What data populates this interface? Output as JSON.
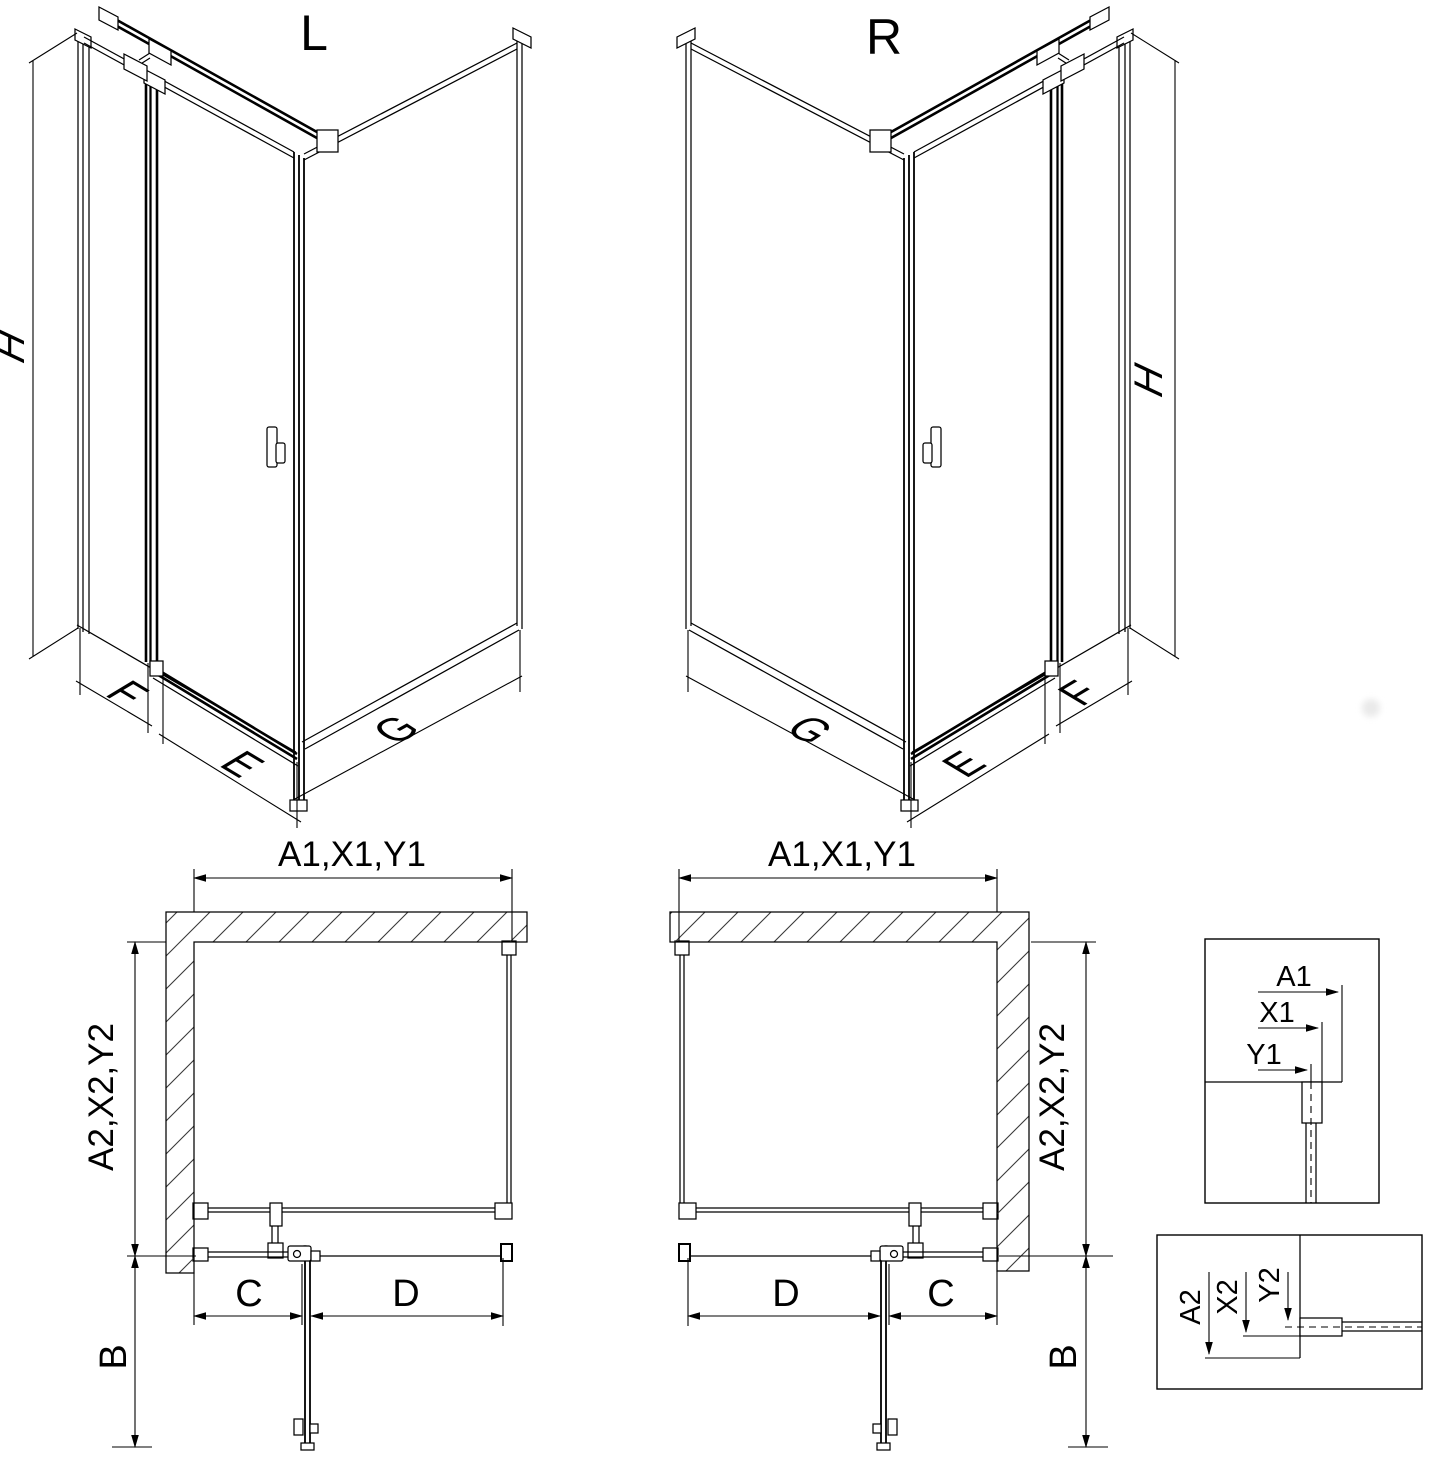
{
  "drawing": {
    "views": {
      "iso_left": {
        "label": "L",
        "dim_height": "H",
        "dim_side": "F",
        "dim_door": "E",
        "dim_wall": "G"
      },
      "iso_right": {
        "label": "R",
        "dim_height": "H",
        "dim_side": "F",
        "dim_door": "E",
        "dim_wall": "G"
      },
      "plan_left": {
        "dim_width": "A1,X1,Y1",
        "dim_depth": "A2,X2,Y2",
        "dim_b": "B",
        "dim_c": "C",
        "dim_d": "D"
      },
      "plan_right": {
        "dim_width": "A1,X1,Y1",
        "dim_depth": "A2,X2,Y2",
        "dim_b": "B",
        "dim_c": "C",
        "dim_d": "D"
      },
      "detail_top": {
        "dim_a1": "A1",
        "dim_x1": "X1",
        "dim_y1": "Y1"
      },
      "detail_bottom": {
        "dim_a2": "A2",
        "dim_x2": "X2",
        "dim_y2": "Y2"
      }
    },
    "colors": {
      "line": "#000000",
      "background": "#ffffff",
      "watermark": "#e9e9e9"
    }
  }
}
